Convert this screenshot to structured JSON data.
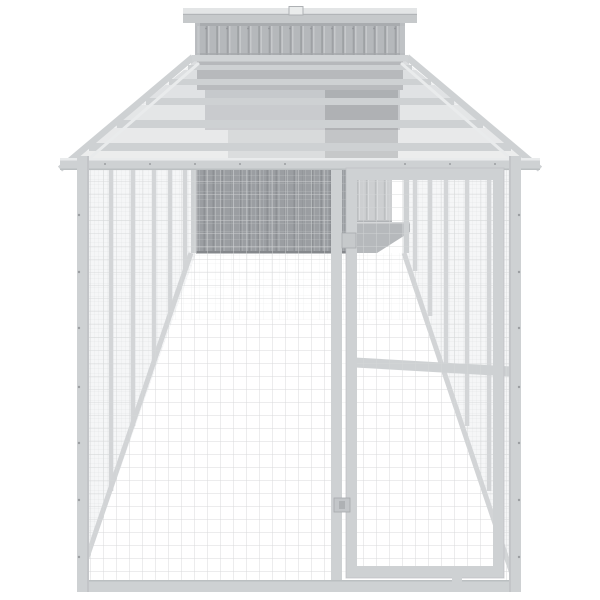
{
  "scene": {
    "type": "product-render",
    "description": "Light grey galvanised steel dog kennel: elevated corrugated-metal house at the far end and a long wire-mesh run with a front mesh door, shown in one-point perspective on a plain white background",
    "background": "#ffffff"
  },
  "colors": {
    "bg": "#ffffff",
    "frame": "#ced1d3",
    "frameHi": "#e9ebec",
    "frameEdge": "#b7babd",
    "meshLine": "#d5d7d9",
    "meshFine": "#c8cbcd",
    "floorLine": "#dadcde",
    "corrBase": "#b5b8bb",
    "corrGroove": "#9ea1a4",
    "corrHi": "#c6c9cb",
    "roofCap": "#e3e5e6",
    "roofFascia": "#c6c9cb",
    "underShadow": "#a9acaf",
    "darkBase": "#9b9ea2",
    "darkGroove": "#8d9094",
    "darkHi": "#a7aaad",
    "litBase": "#cdcfd1",
    "litGroove": "#bcbfc1",
    "ramp": "#b6b9bc",
    "bolt": "#9b9ea1"
  },
  "components": {
    "house": {
      "name": "elevated kennel house",
      "roof": "flat metal roof with centre clip",
      "walls": "corrugated steel panels, light grey"
    },
    "run": {
      "name": "wire mesh run",
      "roof": "sloped mesh roof with cross beams",
      "sides": "mesh side walls with steel posts",
      "floor": "wire mesh floor"
    },
    "door": {
      "name": "front mesh door",
      "latch": "slide latch on left stile",
      "hinges": "upper hinge bracket on left stile"
    }
  }
}
